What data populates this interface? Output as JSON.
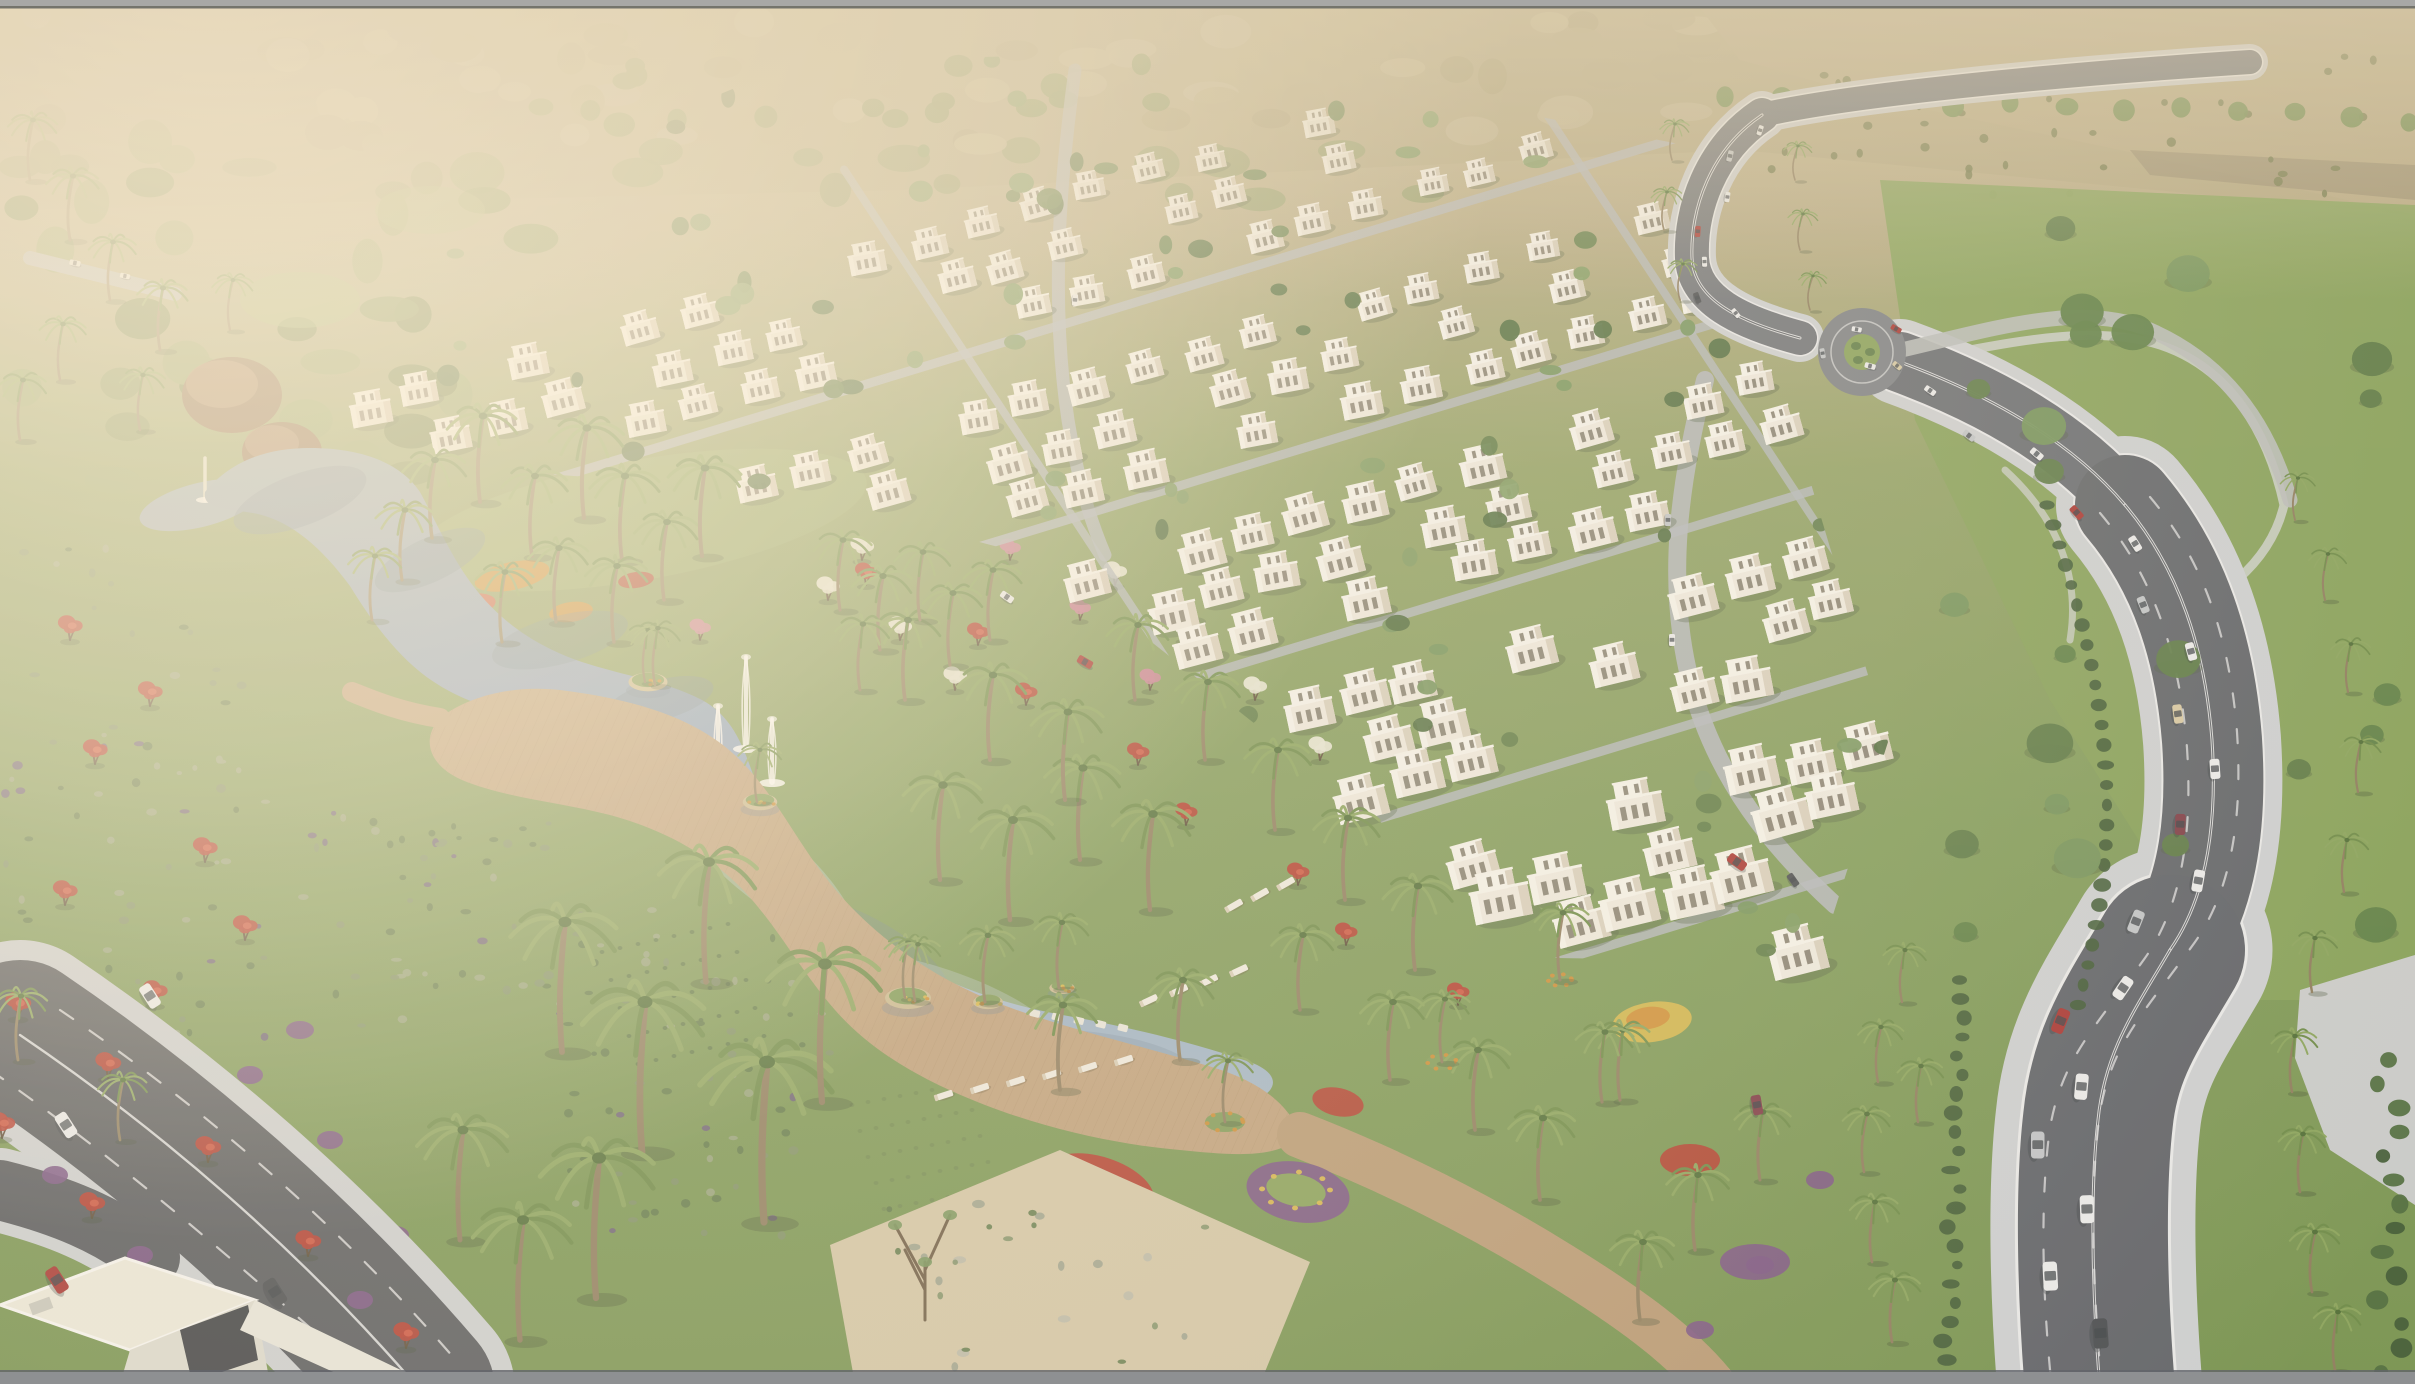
{
  "scene": {
    "title": "Aerial architectural rendering of a master-planned villa community",
    "description": "Photorealistic bird's-eye render: rows of white desert villas, a central lake with fountains and wooden boardwalk, palm gardens, flowering trees, a curved divided avenue with traffic and a roundabout, hazy sunlit tree line on the horizon",
    "regions": [
      "horizon-haze",
      "distant-tree-line",
      "dry-field",
      "villa-district",
      "internal-streets",
      "main-avenue",
      "roundabout",
      "traffic",
      "central-lake",
      "fountains",
      "lake-islands",
      "boardwalk-deck",
      "sun-loungers",
      "palm-grove",
      "gardens",
      "flower-beds",
      "meadow",
      "boulevard",
      "corner-building",
      "frame-bars"
    ],
    "text_in_image": []
  },
  "palette": {
    "frame_top": "#a8a8a6",
    "frame_top_line": "#74746c",
    "frame_bottom": "#8e9092",
    "frame_bottom_line": "#62646a",
    "haze_top": "#c8b792",
    "haze_mid": "#b5a981",
    "ground_green": "#7f9b58",
    "ground_green_deep": "#76934f",
    "canopy_far": "#b3a67e",
    "canopy_far_light": "#c0b48e",
    "canopy_far_dark": "#a89d74",
    "canopy_far_green": "#8f9a66",
    "dry_field": "#b7a982",
    "dry_soil": "#8d8166",
    "scrub_dark": "#6d7546",
    "tree_green": "#5c7a45",
    "tree_green_dark": "#4e6c3c",
    "tree_green_light": "#74945a",
    "tree_olive": "#7c8f56",
    "lawn": "#86a158",
    "lawn_light": "#9db46e",
    "meadow_shrub": "#5d7848",
    "meadow_shrub_gray": "#7d8f66",
    "meadow_shrub_pale": "#97a37e",
    "meadow_shrub_purple": "#6a5d78",
    "sand": "#d3c6a6",
    "path_light": "#c9cdc4",
    "rock_gray": "#9aa08c",
    "water_top": "#98a9b4",
    "water_mid": "#8aa2c0",
    "water_low": "#a3b7c8",
    "water_dark": "#6e8496",
    "water_sheen": "#c2cfd6",
    "deck": "#bfa07a",
    "deck_dark": "#a5845e",
    "deck_light": "#d2b68d",
    "villa_body": "#efebe0",
    "villa_side": "#d9d0bd",
    "villa_light": "#f7f4ec",
    "villa_window": "#6e6858",
    "villa_shadow": "#4e5c3e",
    "asphalt": "#6e7277",
    "asphalt_dark": "#55585c",
    "road_light": "#b2b6ba",
    "sidewalk": "#cdd0d2",
    "lane_white": "#e9eaea",
    "hedge": "#3f5a34",
    "flower_red": "#b43a2c",
    "flower_red_light": "#d25a43",
    "flower_orange": "#cf8c33",
    "flower_yellow": "#d9b84a",
    "flower_purple": "#7a5383",
    "flower_pink": "#c97f93",
    "flower_white": "#e7e6d4",
    "palm_trunk": "#8d7c5c",
    "palm_frond": "#6b8a46",
    "palm_frond_light": "#8aa45c",
    "palm_core": "#4c6a34",
    "rock_brown": "#8a6a4c",
    "rock_brown_light": "#a98a66",
    "car_white": "#ebecec",
    "car_silver": "#c0c4c7",
    "car_red": "#a83430",
    "car_dark": "#474b4f",
    "car_tan": "#d6c8a2",
    "car_maroon": "#7d3a45",
    "car_glass": "#3a4046",
    "building_white": "#eceada",
    "building_wall": "#dddbcf",
    "building_glass": "#3c4043",
    "glow": "#fff3da",
    "glow_soft": "#f3e7ce",
    "haze_warm": "#e0d2b2"
  }
}
